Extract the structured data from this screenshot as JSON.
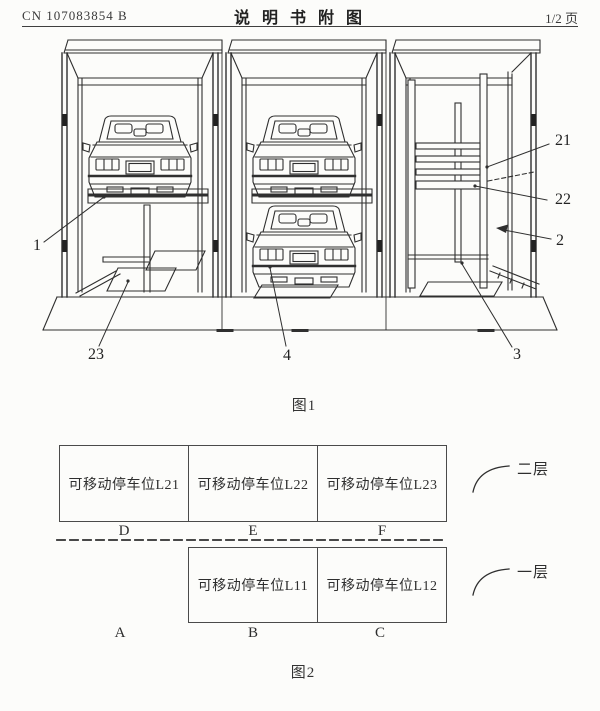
{
  "header": {
    "patent_number": "CN 107083854 B",
    "title": "说 明 书 附 图",
    "page_indicator": "1/2 页"
  },
  "figure1": {
    "caption": "图1",
    "ref_labels": [
      {
        "id": "1",
        "text": "1"
      },
      {
        "id": "2",
        "text": "2"
      },
      {
        "id": "3",
        "text": "3"
      },
      {
        "id": "4",
        "text": "4"
      },
      {
        "id": "21",
        "text": "21"
      },
      {
        "id": "22",
        "text": "22"
      },
      {
        "id": "23",
        "text": "23"
      }
    ]
  },
  "figure2": {
    "caption": "图2",
    "layer_labels": {
      "second": "二层",
      "first": "一层"
    },
    "second_layer_cells": [
      {
        "label": "可移动停车位L21",
        "position": "D"
      },
      {
        "label": "可移动停车位L22",
        "position": "E"
      },
      {
        "label": "可移动停车位L23",
        "position": "F"
      }
    ],
    "first_layer": {
      "empty_position": "A",
      "cells": [
        {
          "label": "可移动停车位L11",
          "position": "B"
        },
        {
          "label": "可移动停车位L12",
          "position": "C"
        }
      ]
    }
  },
  "colors": {
    "line": "#2f2f2f",
    "text": "#333333",
    "background": "#fcfcfa"
  }
}
